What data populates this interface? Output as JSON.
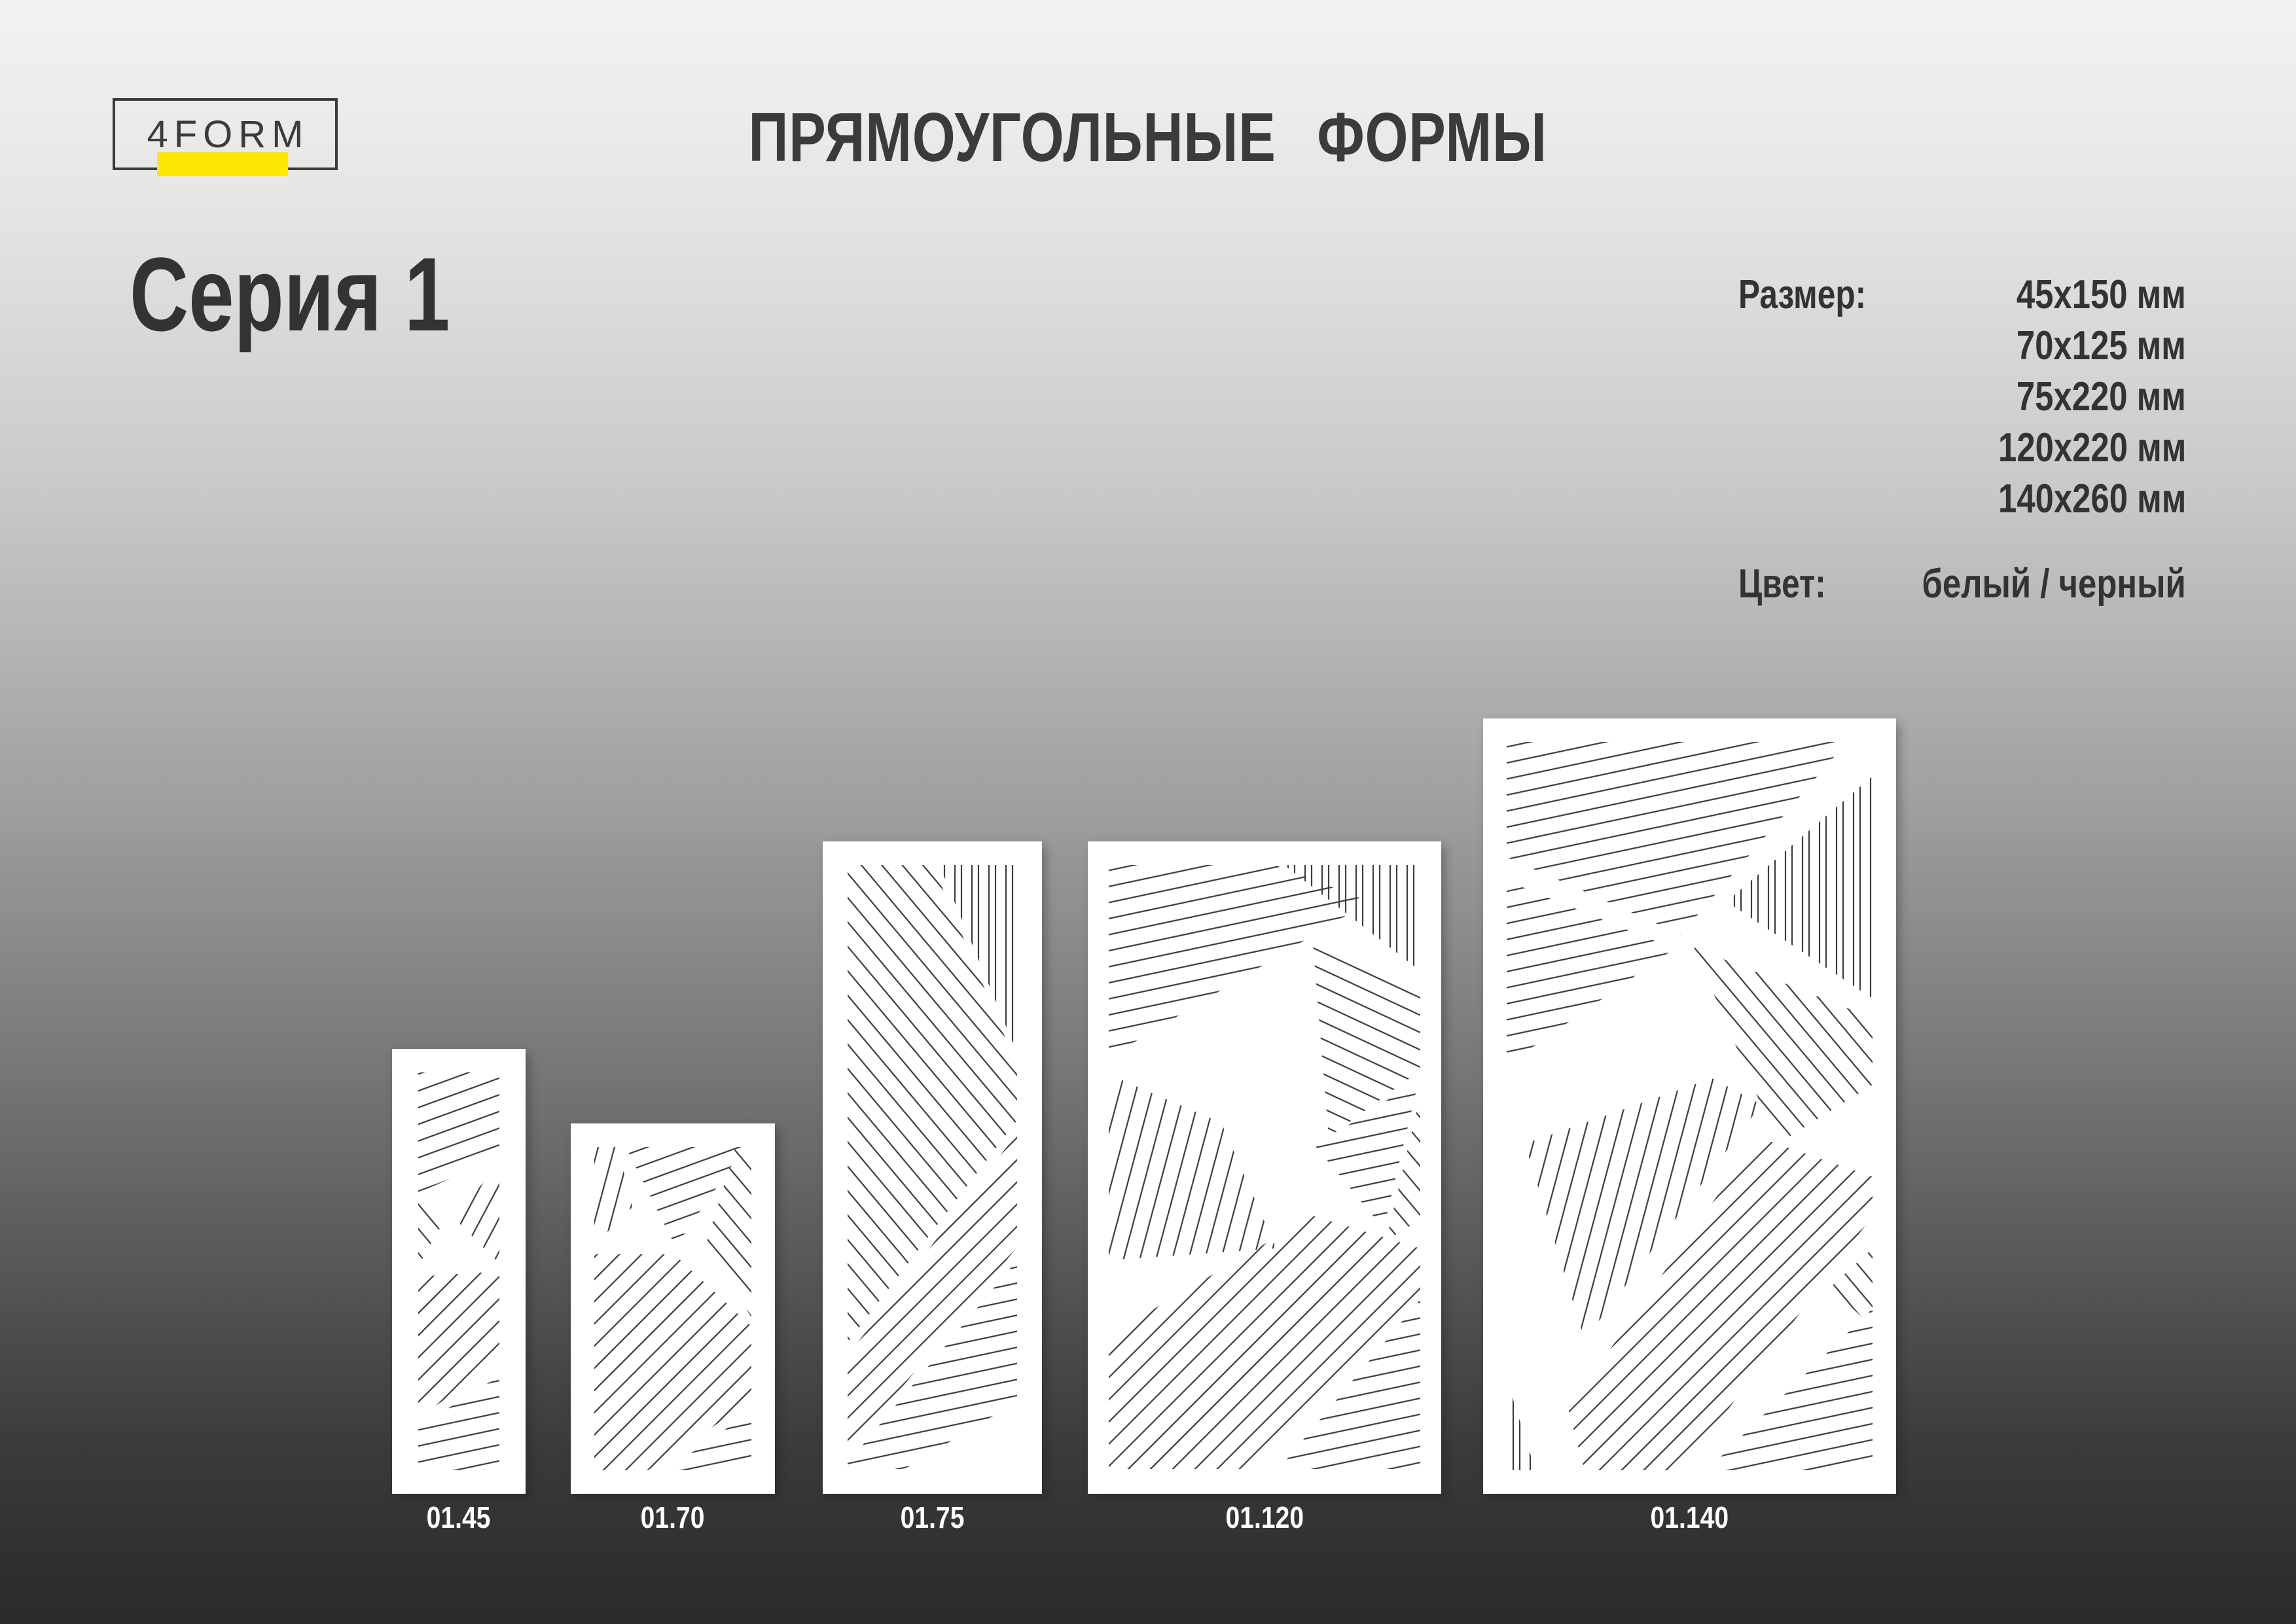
{
  "logo": {
    "text": "4FORM",
    "accent_color": "#ffe703"
  },
  "page": {
    "title": "ПРЯМОУГОЛЬНЫЕ ФОРМЫ"
  },
  "series": {
    "title": "Серия 1"
  },
  "specs": {
    "size_label": "Размер:",
    "sizes": [
      "45x150 мм",
      "70x125 мм",
      "75x220 мм",
      "120x220 мм",
      "140x260 мм"
    ],
    "color_label": "Цвет:",
    "color_value": "белый / черный"
  },
  "panels": [
    {
      "code": "01.45"
    },
    {
      "code": "01.70"
    },
    {
      "code": "01.75"
    },
    {
      "code": "01.120"
    },
    {
      "code": "01.140"
    }
  ],
  "colors": {
    "background_top": "#f3f3f1",
    "background_bottom": "#2a2a28",
    "text": "#333332",
    "panel_background": "#ffffff",
    "pattern_stroke": "#3d3d3d",
    "panel_code_text": "#ffffff",
    "logo_accent": "#ffe703"
  }
}
